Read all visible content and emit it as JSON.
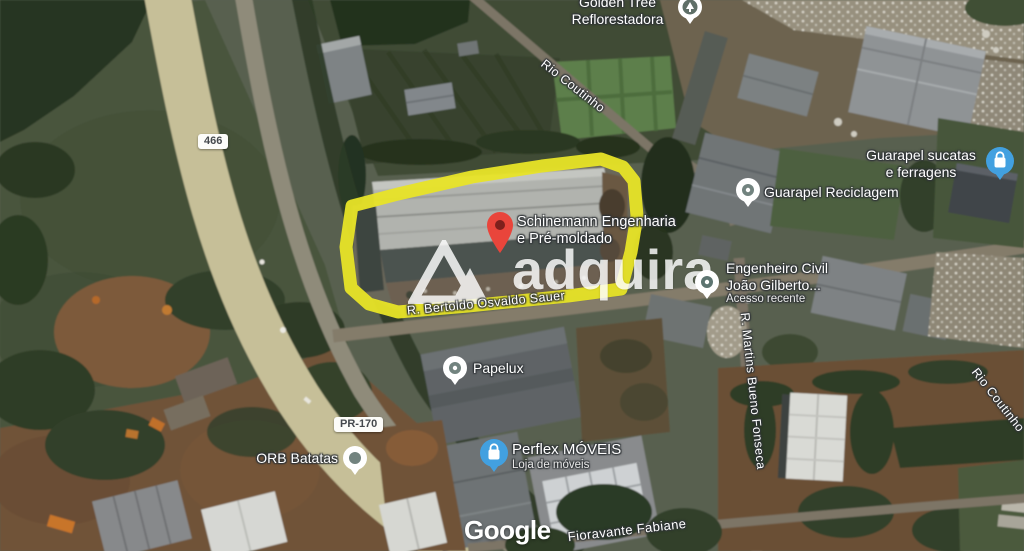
{
  "map_overlay": {
    "attribution": "Google",
    "watermark": "adquira",
    "road_shields": [
      {
        "label": "466"
      },
      {
        "label": "PR-170"
      }
    ],
    "street_labels": {
      "rio_coutinho_top": "Rio Coutinho",
      "bertoldo": "R. Bertoldo Osvaldo Sauer",
      "martins": "R. Martins Bueno Fonseca",
      "rio_coutinho_right": "Rio Coutinho",
      "fioravante": "Fioravante Fabiane"
    },
    "pois": {
      "golden_tree": {
        "line1": "Golden Tree",
        "line2": "Reflorestadora"
      },
      "guarapel_sucatas": {
        "line1": "Guarapel sucatas",
        "line2": "e ferragens"
      },
      "guarapel_reciclagem": {
        "line1": "Guarapel Reciclagem"
      },
      "schinemann": {
        "line1": "Schinemann Engenharia",
        "line2": "e Pré-moldado"
      },
      "engenheiro": {
        "line1": "Engenheiro Civil",
        "line2": "João Gilberto...",
        "sub": "Acesso recente"
      },
      "papelux": {
        "line1": "Papelux"
      },
      "orb": {
        "line1": "ORB Batatas"
      },
      "perflex": {
        "line1": "Perflex MÓVEIS",
        "sub": "Loja de móveis"
      }
    },
    "colors": {
      "highlight_outline": "#e8e427",
      "red_pin": "#e9453b",
      "blue_poi_icon": "#42a0e0",
      "label_text": "#ffffff",
      "shield_text": "#45494d"
    }
  }
}
